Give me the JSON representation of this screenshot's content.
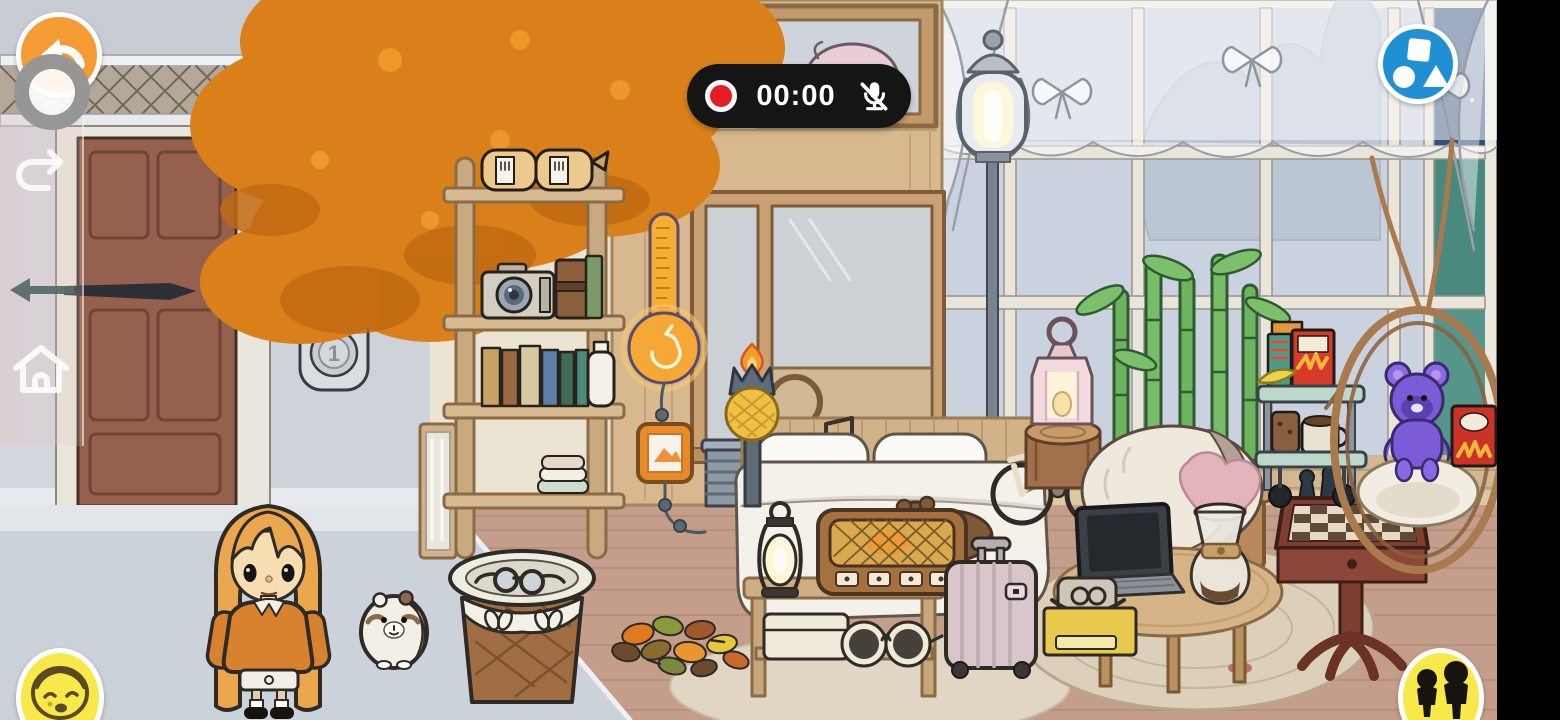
{
  "app_context": "toca-style-room-scene-with-screen-recorder",
  "ui": {
    "recorder_pill": {
      "time": "00:00",
      "record_icon": "record-dot-icon",
      "mic_icon": "muted-mic-icon",
      "background": "#151515",
      "record_color": "#e51c23"
    },
    "back_button": {
      "icon": "back-arrow-icon",
      "color": "#f49b33"
    },
    "record_ring_button": {
      "icon": "record-ring-icon",
      "color": "#808080"
    },
    "build_button": {
      "icon": "shapes-square-circle-triangle-icon",
      "color": "#1f90d4"
    },
    "character_face_button": {
      "icon": "character-face-icon",
      "color": "#f8e84a"
    },
    "residents_button": {
      "icon": "two-residents-icon",
      "color": "#f8e84a"
    },
    "sidebar": {
      "icons": [
        "undo-arrow-icon",
        "swipe-left-arrow-icon",
        "home-icon"
      ]
    }
  },
  "scene": {
    "doorbell": {
      "button_top": "2",
      "button_bottom": "1"
    },
    "objects": [
      "autumn-tree",
      "front-door",
      "doorbell-panel",
      "ladder-shelf",
      "bread-bags",
      "camera",
      "camera-case",
      "books-row",
      "milk-bottle",
      "folded-towels",
      "wall-thermometer",
      "wall-art-frame",
      "sauna-glass-door",
      "radiator",
      "pineapple-torch",
      "street-lamp",
      "pig-picture-alcove",
      "lace-curtains",
      "window-night-panes",
      "bed",
      "pillows",
      "teddy-bear",
      "music-notes",
      "camping-lantern",
      "vintage-radio",
      "side-table",
      "storage-box",
      "sunglasses",
      "suitcase",
      "bicycle",
      "stump-table",
      "pink-lantern",
      "bamboo-plant",
      "heart-beanbag",
      "round-coffee-table",
      "laptop",
      "pour-over-coffee",
      "camera-bag-crate",
      "chess-table",
      "chess-pieces",
      "snack-cart",
      "snacks",
      "hanging-egg-chair",
      "purple-teddy-bear",
      "chips-bag",
      "round-rug",
      "picnic-basket",
      "autumn-leaves",
      "girl-character",
      "pet-hamster"
    ],
    "colors": {
      "interior_wall": "#dcc7a9",
      "exterior_wall": "#d4d7de",
      "interior_floor": "#c49e8b",
      "exterior_floor": "#cbd2d9",
      "tree_foliage": "#d9801b",
      "door": "#96604f",
      "night_sky": "#31507e",
      "night_hills": "#4a8a7e",
      "bamboo": "#6db45f",
      "suitcase": "#d8c6cb",
      "purple_bear": "#7b5bd6"
    }
  }
}
